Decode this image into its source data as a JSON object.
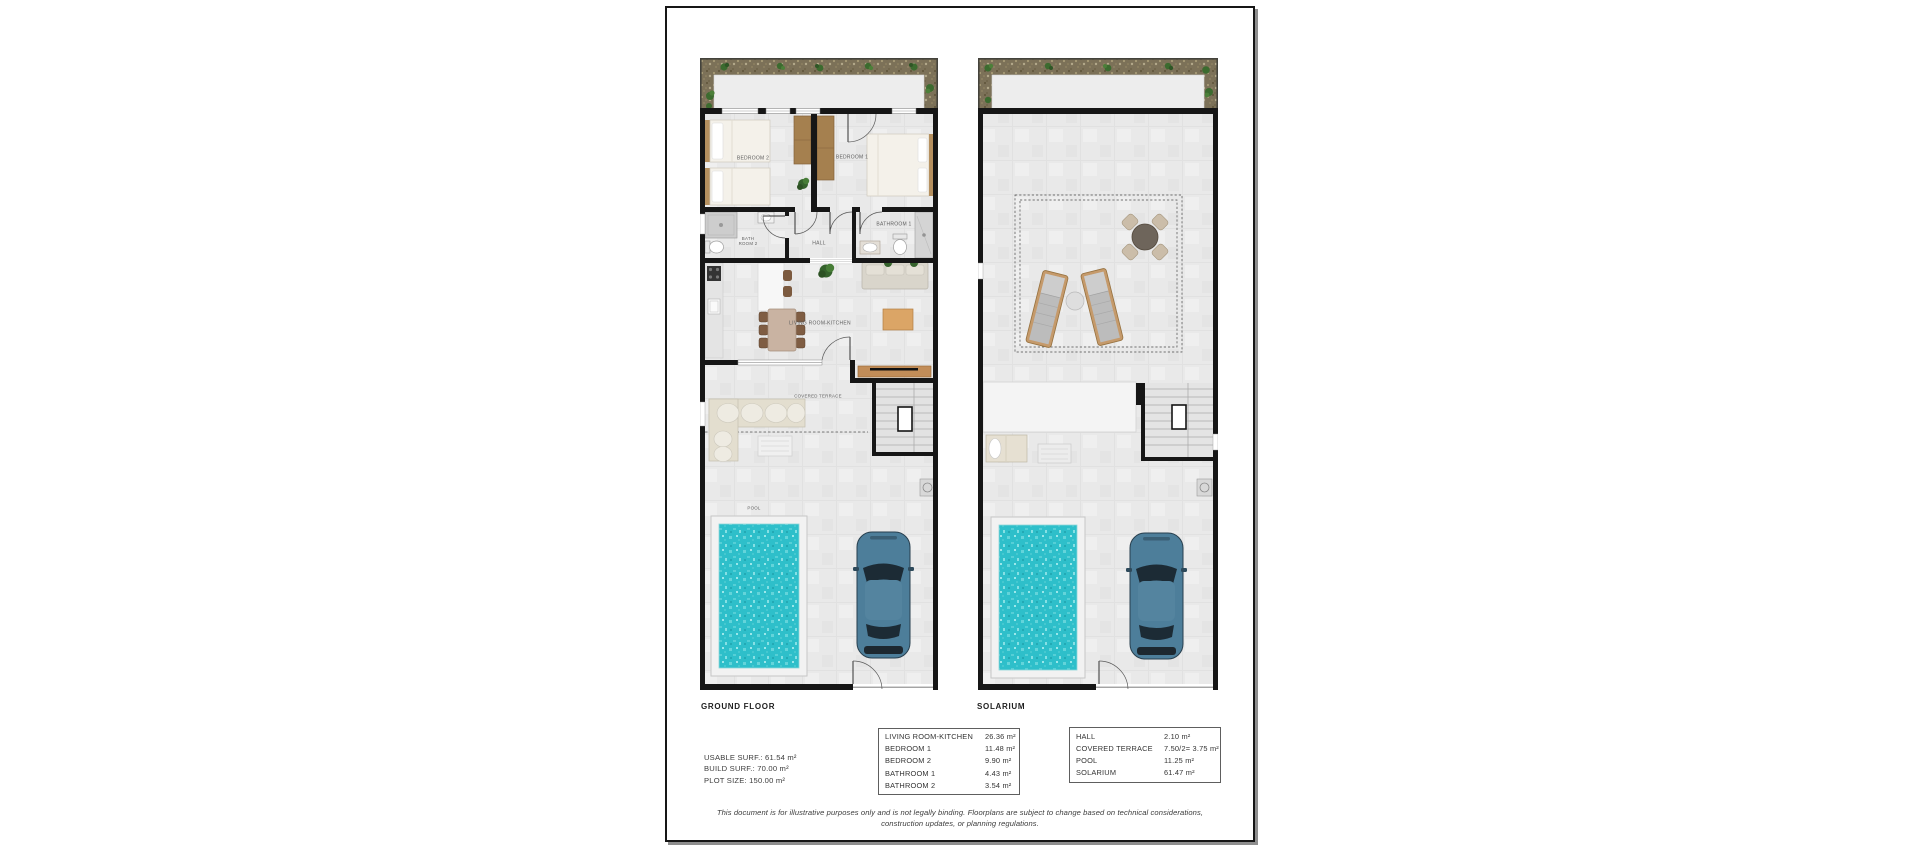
{
  "document": {
    "ground_floor": {
      "caption": "GROUND FLOOR",
      "room_labels": {
        "bedroom2": "BEDROOM 2",
        "bedroom1": "BEDROOM 1",
        "bathroom2_l1": "BATH",
        "bathroom2_l2": "ROOM 2",
        "hall": "HALL",
        "bathroom1": "BATHROOM 1",
        "living_kitchen": "LIVING ROOM-KITCHEN",
        "covered_terrace": "COVERED TERRACE",
        "pool": "POOL"
      }
    },
    "solarium": {
      "caption": "SOLARIUM"
    },
    "stats": {
      "usable": "USABLE SURF.: 61.54 m²",
      "build": "BUILD SURF.: 70.00 m²",
      "plot": "PLOT SIZE: 150.00 m²"
    },
    "area_tables": {
      "ground": {
        "rows": [
          [
            "LIVING ROOM-KITCHEN",
            "26.36 m²"
          ],
          [
            "BEDROOM 1",
            "11.48 m²"
          ],
          [
            "BEDROOM 2",
            "9.90 m²"
          ],
          [
            "BATHROOM 1",
            "4.43 m²"
          ],
          [
            "BATHROOM 2",
            "3.54 m²"
          ]
        ]
      },
      "solarium": {
        "rows": [
          [
            "HALL",
            "2.10 m²"
          ],
          [
            "COVERED TERRACE",
            "7.50/2= 3.75 m²"
          ],
          [
            "POOL",
            "11.25 m²"
          ],
          [
            "SOLARIUM",
            "61.47 m²"
          ]
        ]
      }
    },
    "disclaimer": {
      "line1": "This document is for illustrative purposes only and is not legally binding. Floorplans are subject to change based on technical considerations,",
      "line2": "construction updates, or planning regulations."
    },
    "colors": {
      "wall": "#161616",
      "floor": "#e9e9e9",
      "pool_water": "#2ebfca",
      "car_body": "#4d7e9a",
      "wood": "#a5804f",
      "gravel": "#7c7158"
    }
  }
}
